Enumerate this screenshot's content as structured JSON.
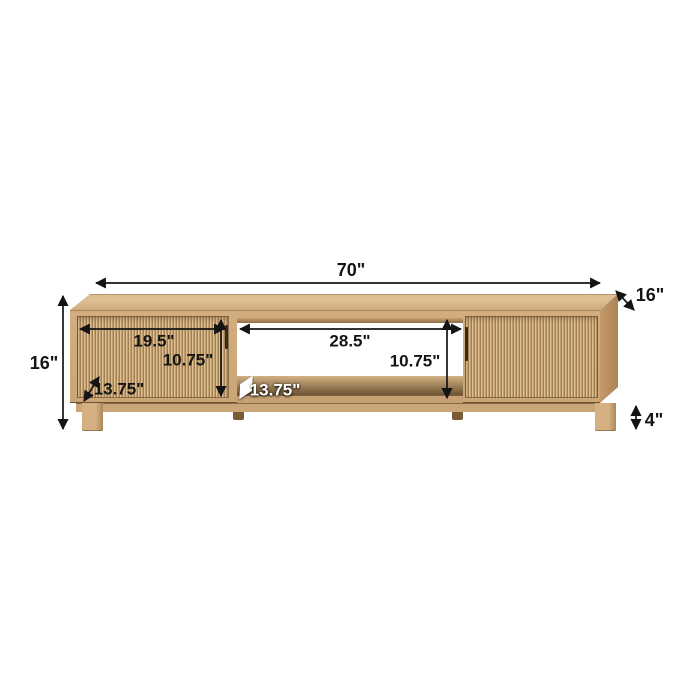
{
  "diagram": {
    "type": "product-dimension-diagram",
    "product": "fluted-two-door-tv-stand",
    "colors": {
      "background": "#ffffff",
      "wood_base": "#cca574",
      "flute_light": "#dcc093",
      "flute_dark": "#a18053",
      "annotation_text": "#141414",
      "annotation_text_alt": "#ffffff"
    },
    "labels": {
      "overall_width": "70\"",
      "depth": "16\"",
      "overall_height": "16\"",
      "left_door_width": "19.5\"",
      "left_door_height": "10.75\"",
      "left_compartment_depth": "13.75\"",
      "center_opening_width": "28.5\"",
      "center_opening_height": "10.75\"",
      "center_shelf_depth": "13.75\"",
      "leg_height": "4\""
    }
  }
}
